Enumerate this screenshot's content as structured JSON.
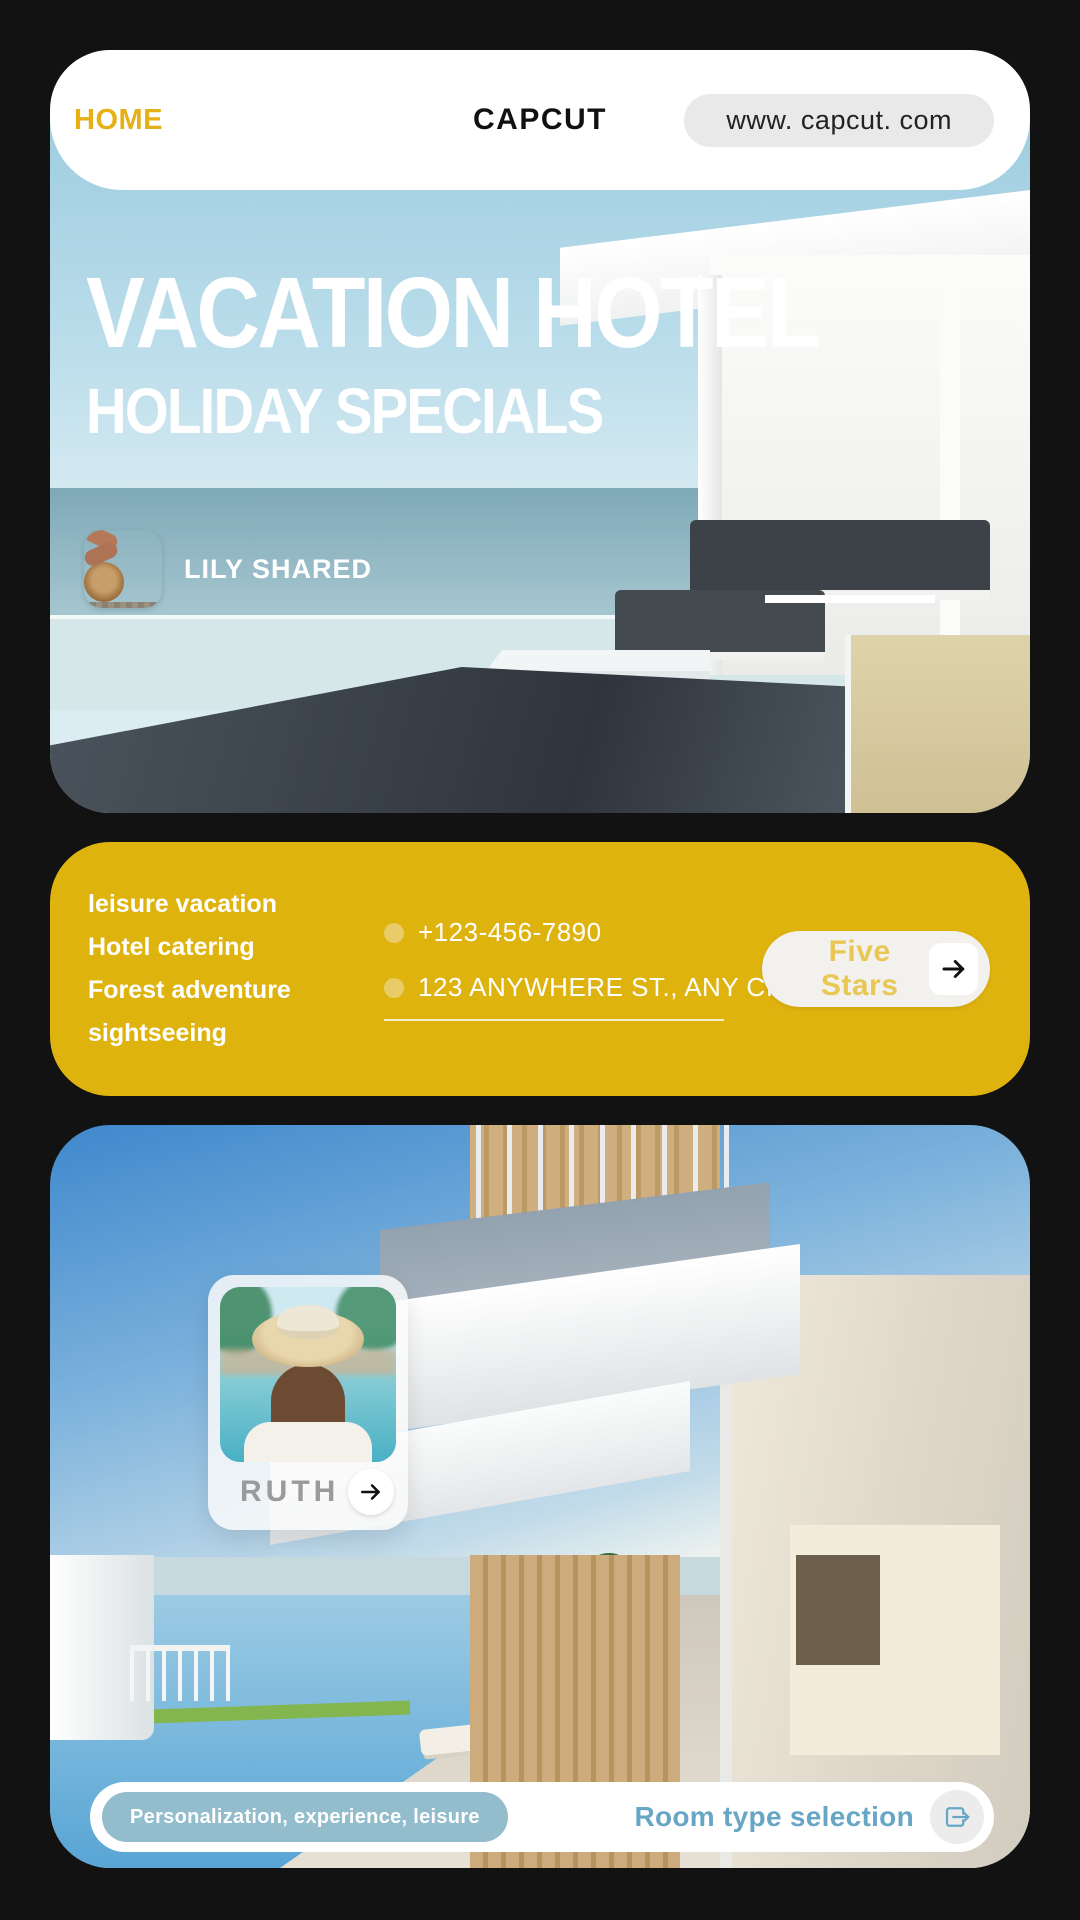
{
  "header": {
    "home_label": "HOME",
    "brand": "CAPCUT",
    "url": "www. capcut. com"
  },
  "hero": {
    "title": "VACATION HOTEL",
    "subtitle": "HOLIDAY SPECIALS",
    "shared_by": "LILY SHARED"
  },
  "info": {
    "services": [
      "leisure vacation",
      "Hotel catering",
      "Forest adventure",
      "sightseeing"
    ],
    "phone": "+123-456-7890",
    "address": "123 ANYWHERE ST., ANY CITY",
    "cta_label": "Five Stars"
  },
  "feature": {
    "profile_name": "RUTH",
    "tag_label": "Personalization, experience, leisure",
    "cta_label": "Room type selection"
  },
  "icons": {
    "five_stars_arrow": "arrow-right-icon",
    "profile_arrow": "arrow-right-icon",
    "room_select": "enter-square-arrow-icon"
  },
  "colors": {
    "page_background": "#121212",
    "accent_gold": "#dfb30e",
    "home_gold": "#e5b117",
    "stars_gold": "#e9c754",
    "link_blue": "#68a6c6",
    "tag_blue": "#93bccd",
    "profile_gray": "#9a9a9a"
  }
}
